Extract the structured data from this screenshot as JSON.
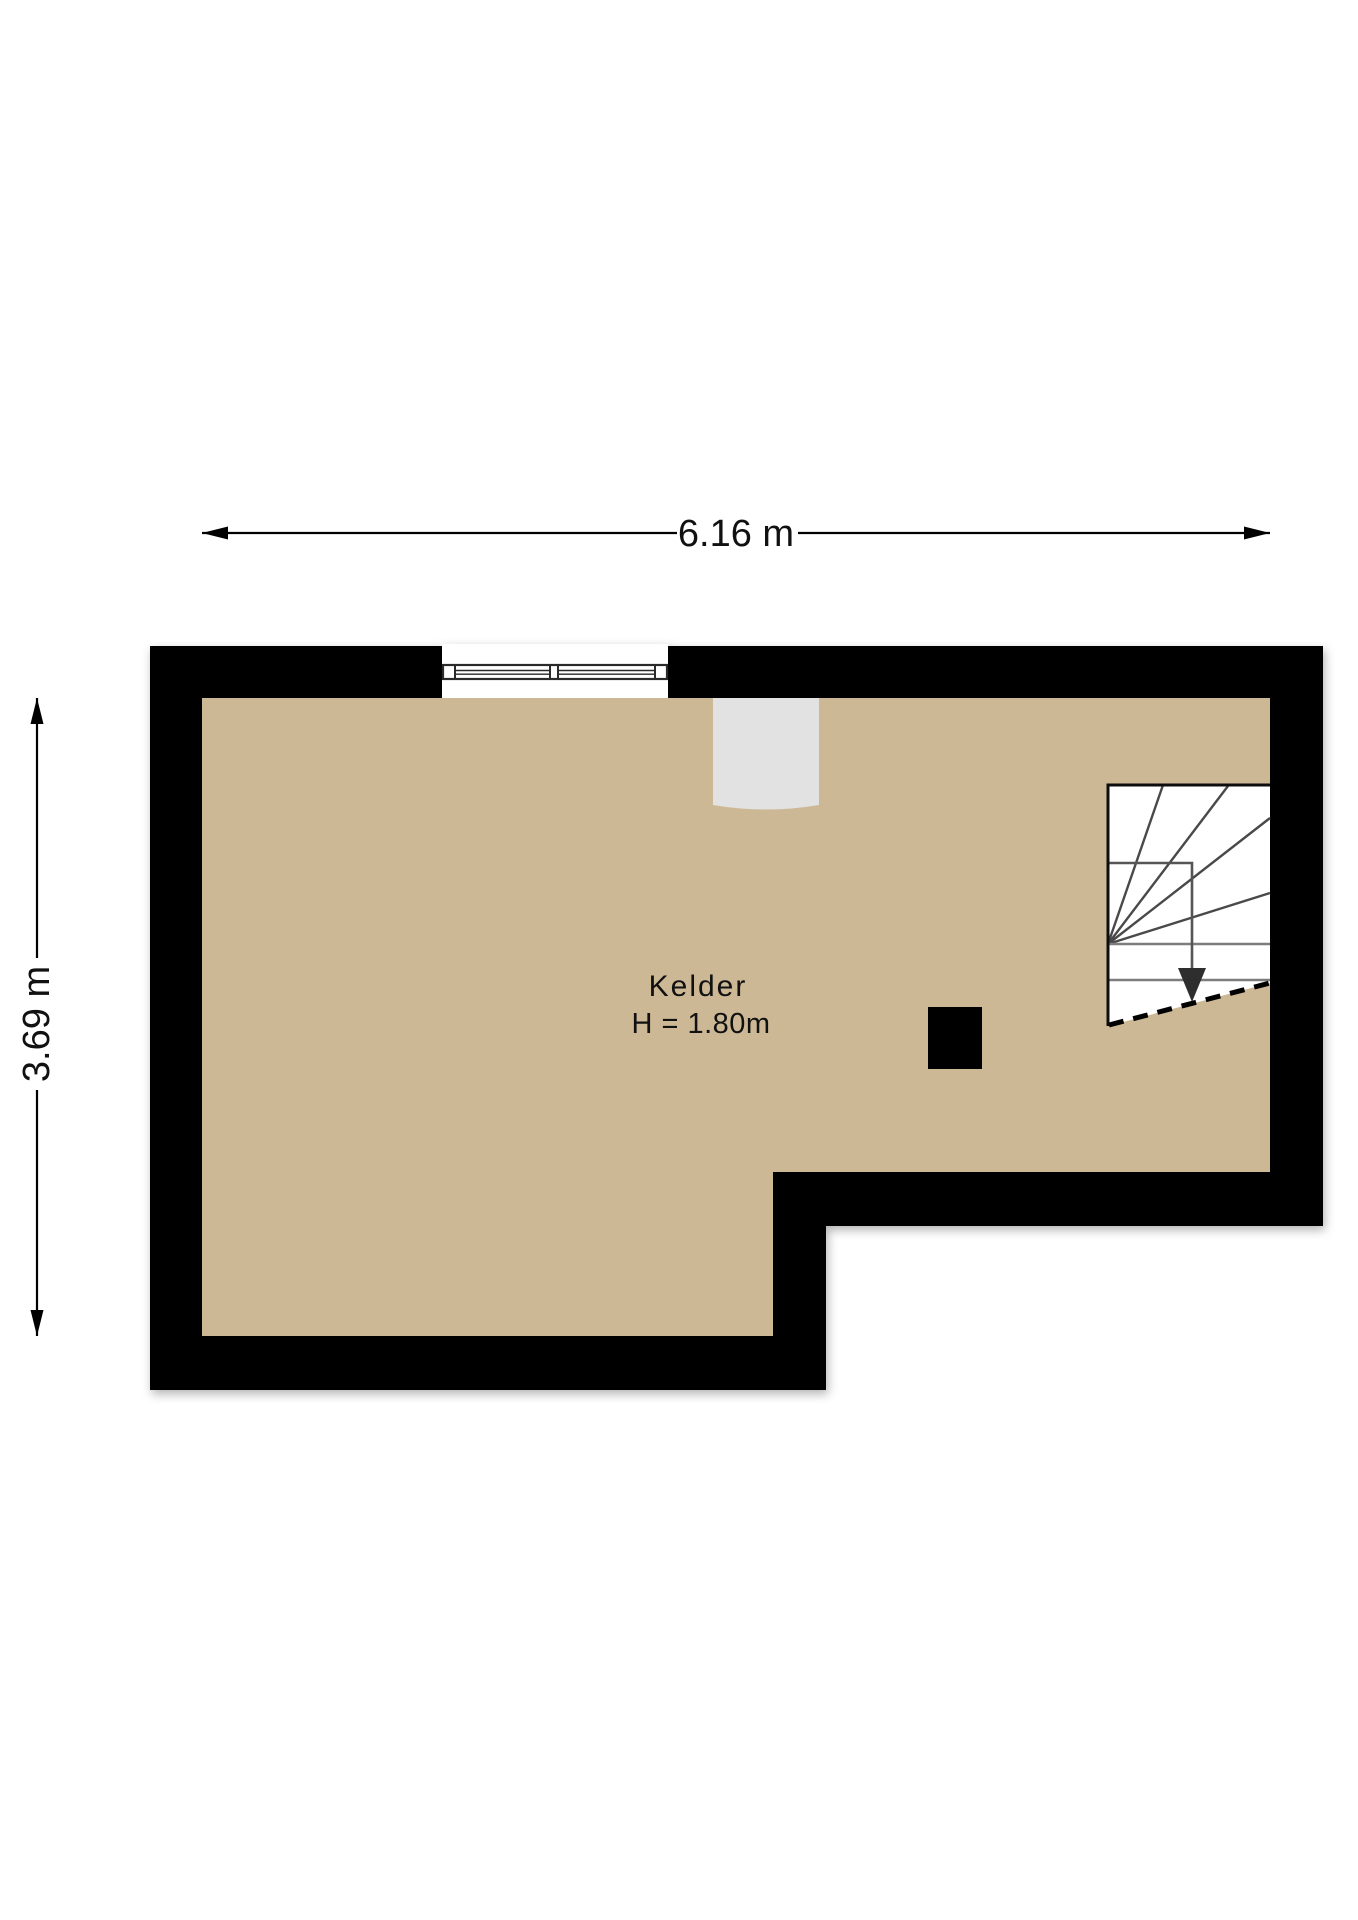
{
  "plan": {
    "title": "Kelder floor plan",
    "room": {
      "name": "Kelder",
      "ceiling_height_label": "H = 1.80m"
    },
    "dimensions": {
      "width_label": "6.16 m",
      "height_label": "3.69 m"
    },
    "colors": {
      "background": "#ffffff",
      "wall": "#000000",
      "floor": "#cdb896",
      "niche": "#e2e2e2",
      "window_fill": "#ffffff",
      "window_frame": "#2a2a2a",
      "stair_fill": "#ffffff",
      "stair_outline": "#111111",
      "stair_fan_line": "#4a4a4a",
      "stair_tread_line": "#7d7d7d",
      "walk_line": "#555555",
      "walk_arrow": "#2e2e2e",
      "dimension_line": "#000000",
      "column": "#000000"
    },
    "elements": {
      "window": "window",
      "niche": "wall-niche",
      "staircase": "staircase-down",
      "column": "column",
      "walk_arrow_icon": "arrow-down-icon"
    }
  }
}
